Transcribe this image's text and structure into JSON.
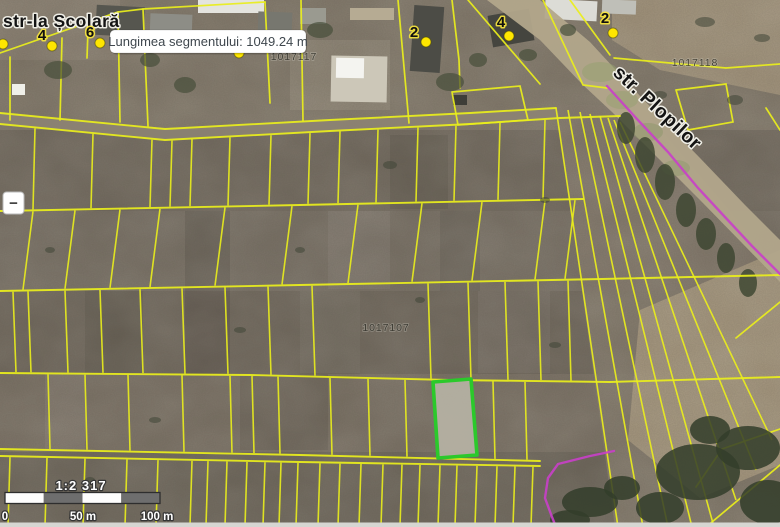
{
  "map": {
    "street_labels": {
      "scolara": "str-la Școlară",
      "plopilor": "str. Plopilor"
    },
    "parcel_numbers": {
      "p1017117": "1017117",
      "p1017118": "1017118",
      "p1017107": "1017107"
    },
    "markers": {
      "m1": "4",
      "m2": "6",
      "m3": "2",
      "m4": "4",
      "m5": "2"
    },
    "tooltip": {
      "label": "Lungimea segmentului: 1049.24 m"
    },
    "controls": {
      "zoom_out": "−"
    },
    "scale": {
      "ratio": "1:2 317",
      "tick0": "0",
      "tick50": "50 m",
      "tick100": "100 m"
    },
    "colors": {
      "parcel_line": "#eaee1c",
      "selected_parcel_stroke": "#2bc92b",
      "measure_highlight": "#c93fc9",
      "marker_fill": "#ffe600"
    }
  }
}
